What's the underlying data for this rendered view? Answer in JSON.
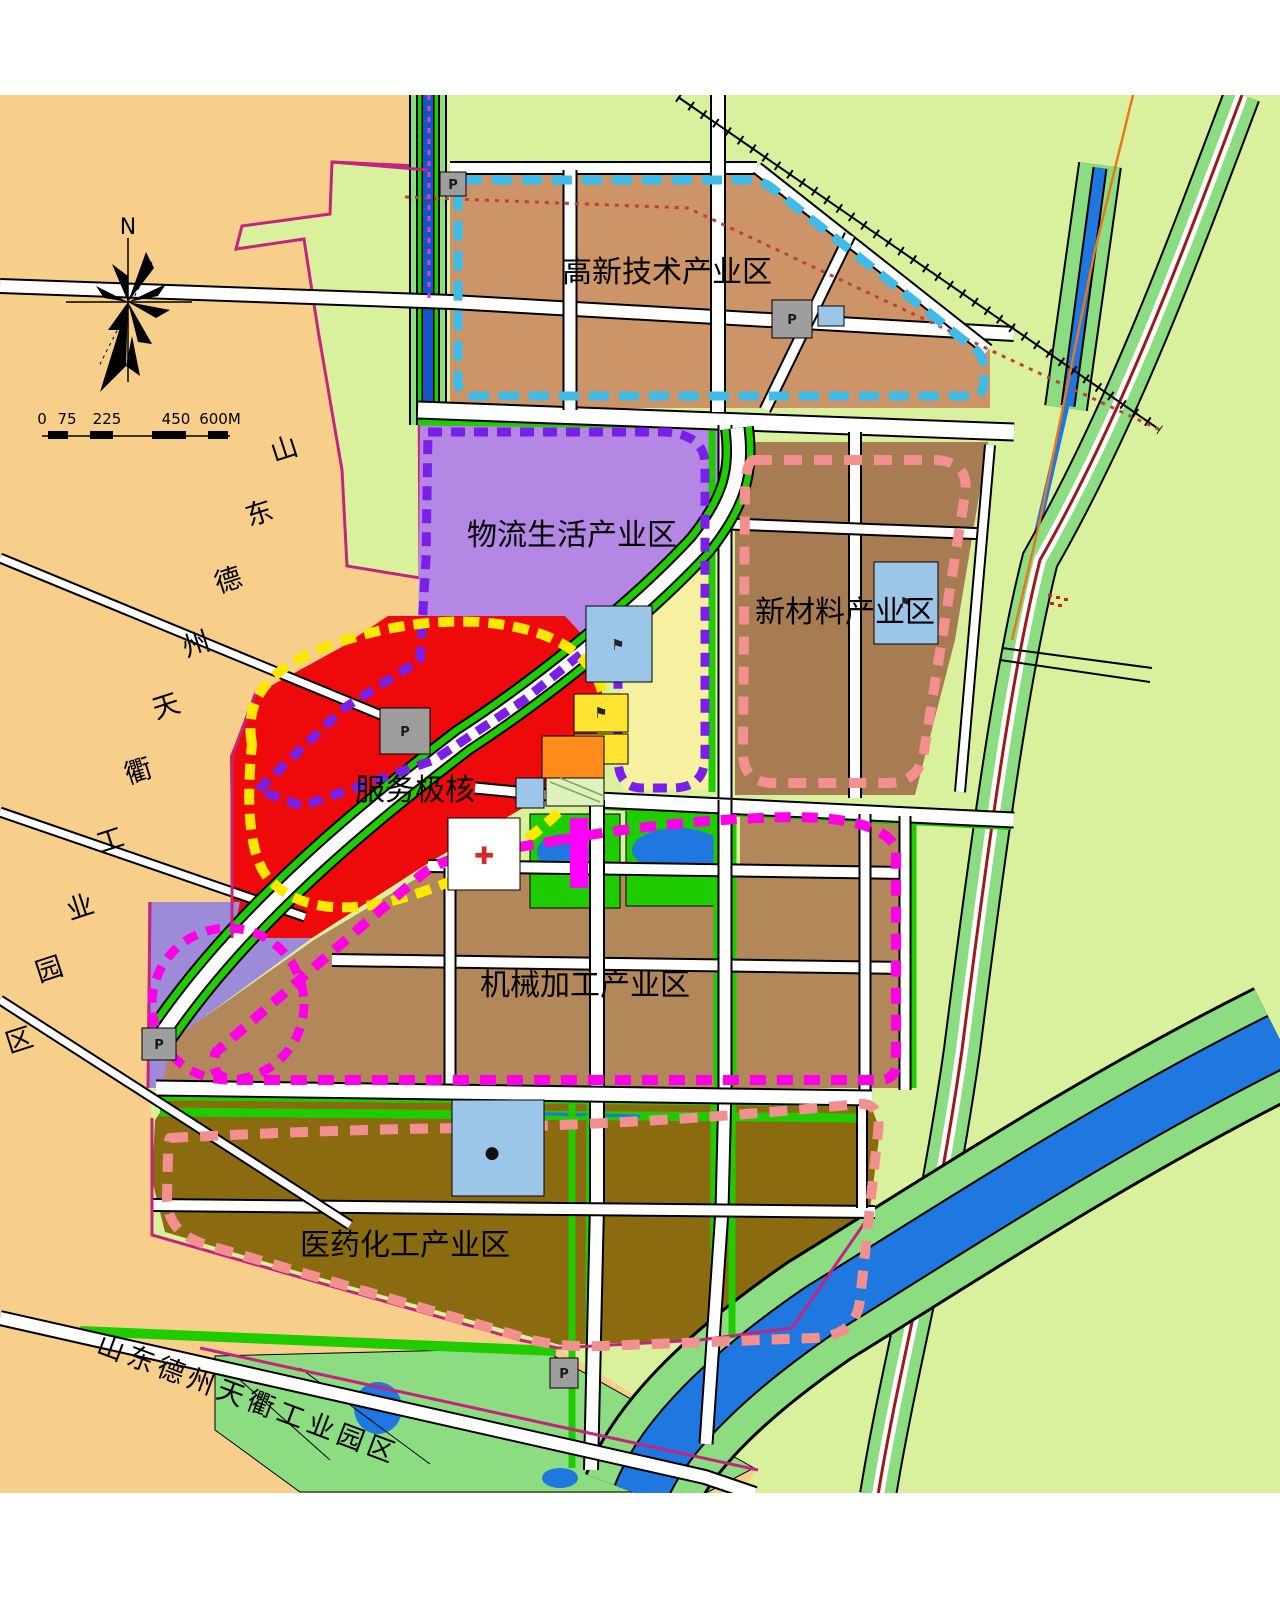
{
  "map": {
    "labels": {
      "gaoxin": "高新技术产业区",
      "wuliu": "物流生活产业区",
      "xincailiao": "新材料产业区",
      "fuwu": "服务极核",
      "jixie": "机械加工产业区",
      "yiyao": "医药化工产业区"
    },
    "side_label": {
      "full": "山东德州天衢工业园区",
      "chars": [
        "山",
        "东",
        "德",
        "州",
        "天",
        "衢",
        "工",
        "业",
        "园",
        "区"
      ]
    },
    "bottom_label": "山东德州天衢工业园区",
    "compass_north": "N",
    "scale_ticks": [
      "0",
      "75",
      "225",
      "450",
      "600M"
    ],
    "icon_glyphs": {
      "parking": "P",
      "hospital": "✚",
      "flag": "⚑",
      "dot": "●"
    },
    "colors": {
      "page_bg": "#FFFFFF",
      "farmland_tan": "#F7CE8A",
      "suburb_green": "#D9F19C",
      "corridor_green": "#8CDC82",
      "strip_green": "#1FCC00",
      "zone_gaoxin": "#CD9467",
      "zone_wuliu": "#B487E4",
      "zone_xincailiao": "#A87C52",
      "zone_fuwu": "#EE0A0A",
      "zone_jixie": "#B2875A",
      "zone_yiyao": "#8B6B10",
      "zone_purple_low": "#9D8BD9",
      "zone_paleyellow": "#F5F1A0",
      "parcel_blue": "#9CC6E8",
      "parcel_yellow": "#FFE431",
      "parcel_orange": "#FF8C1A",
      "parcel_gray": "#9E9E9E",
      "parcel_hatch": "#DFF2BC",
      "water_dark": "#1255C8",
      "water_bright": "#1E78E0",
      "road_white": "#FFFFFF",
      "boundary_cyan": "#3FBBE8",
      "boundary_purple": "#7A1FE8",
      "boundary_salmon": "#F29090",
      "boundary_yellow": "#FFE800",
      "boundary_magenta": "#FF00E6",
      "boundary_crimson": "#C4247E",
      "railway_red": "#9B1B1B",
      "power_orange": "#E8761C",
      "red_dotted": "#C04040",
      "hospital_red": "#D82828",
      "magenta_strip": "#FF00FF"
    }
  }
}
